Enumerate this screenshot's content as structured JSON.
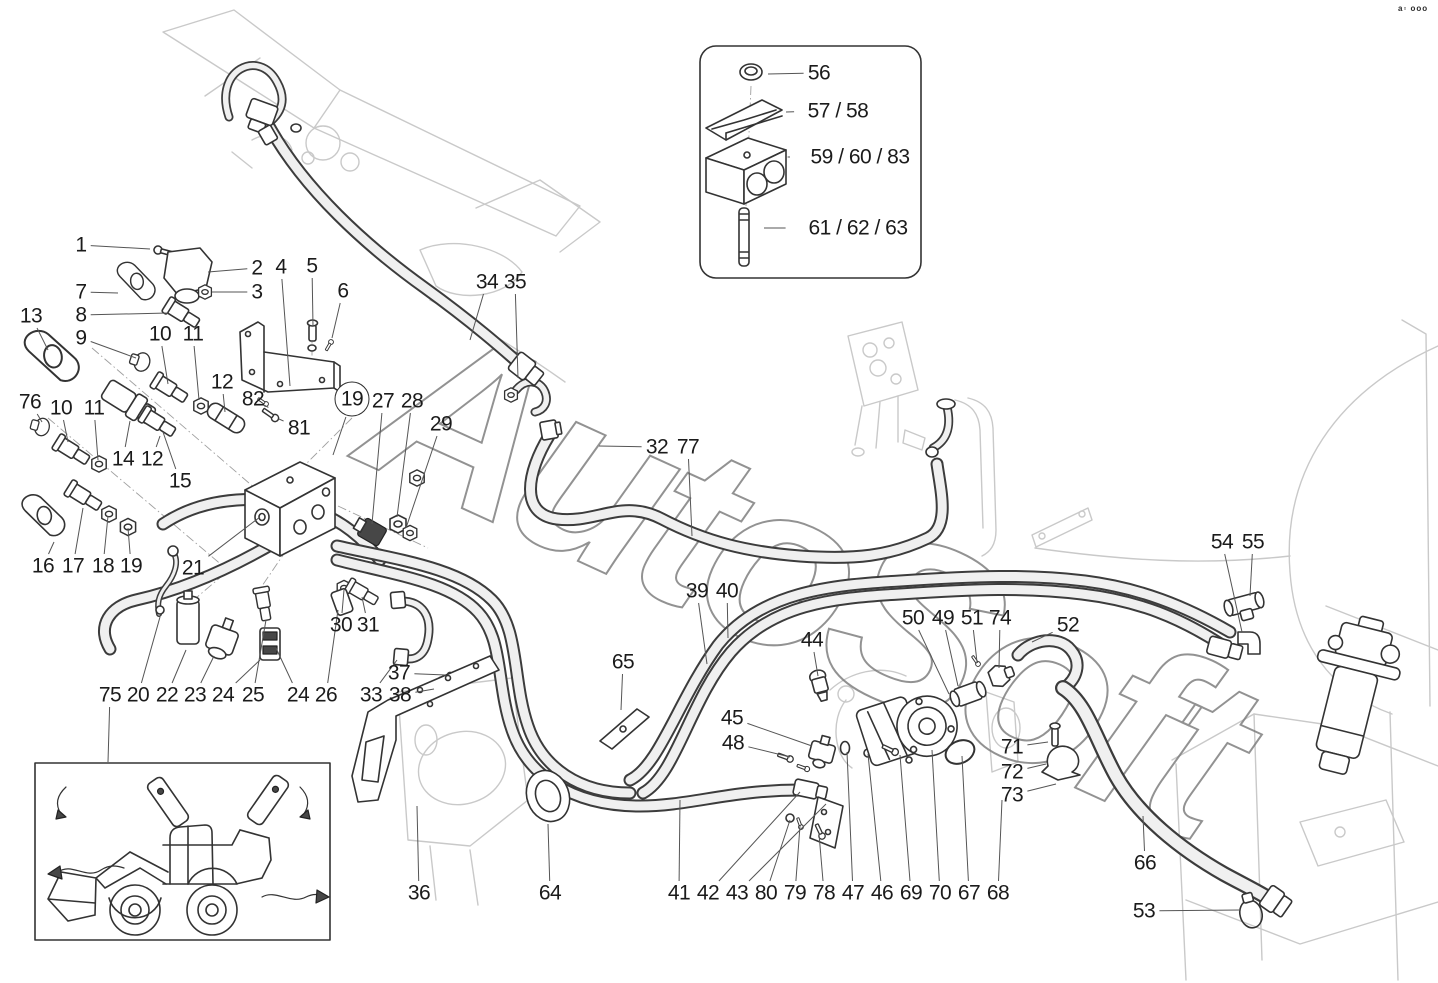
{
  "diagram": {
    "title": "hydraulic-lines-parts-diagram",
    "watermark": "AutoSoft",
    "corner_marks": "a▫ ooo",
    "accent_colors": {
      "ink": "#333333",
      "ghost": "#c9c9c9",
      "hose_core": "#f0f0f0"
    },
    "callouts": [
      {
        "label": "1",
        "x": 81,
        "y": 245,
        "lx": 150,
        "ly": 249
      },
      {
        "label": "2",
        "x": 257,
        "y": 268,
        "lx": 208,
        "ly": 272
      },
      {
        "label": "3",
        "x": 257,
        "y": 292,
        "lx": 212,
        "ly": 292
      },
      {
        "label": "7",
        "x": 81,
        "y": 292,
        "lx": 118,
        "ly": 293
      },
      {
        "label": "8",
        "x": 81,
        "y": 315,
        "lx": 168,
        "ly": 313
      },
      {
        "label": "9",
        "x": 81,
        "y": 338,
        "lx": 136,
        "ly": 358
      },
      {
        "label": "13",
        "x": 31,
        "y": 316,
        "lx": 48,
        "ly": 350
      },
      {
        "label": "10",
        "x": 160,
        "y": 334,
        "lx": 168,
        "ly": 384
      },
      {
        "label": "11",
        "x": 193,
        "y": 334,
        "lx": 199,
        "ly": 400
      },
      {
        "label": "4",
        "x": 281,
        "y": 267,
        "lx": 290,
        "ly": 386
      },
      {
        "label": "5",
        "x": 312,
        "y": 266,
        "lx": 313,
        "ly": 326
      },
      {
        "label": "6",
        "x": 343,
        "y": 291,
        "lx": 332,
        "ly": 338
      },
      {
        "label": "12",
        "x": 222,
        "y": 382,
        "lx": 225,
        "ly": 412
      },
      {
        "label": "82",
        "x": 253,
        "y": 399,
        "lx": 264,
        "ly": 405
      },
      {
        "label": "81",
        "x": 299,
        "y": 428,
        "lx": 279,
        "ly": 419
      },
      {
        "label": "76",
        "x": 30,
        "y": 402,
        "lx": 42,
        "ly": 422
      },
      {
        "label": "10",
        "x": 61,
        "y": 408,
        "lx": 68,
        "ly": 442
      },
      {
        "label": "11",
        "x": 94,
        "y": 408,
        "lx": 98,
        "ly": 460
      },
      {
        "label": "14",
        "x": 123,
        "y": 459,
        "lx": 130,
        "ly": 421
      },
      {
        "label": "12",
        "x": 152,
        "y": 459,
        "lx": 160,
        "ly": 436
      },
      {
        "label": "15",
        "x": 180,
        "y": 481,
        "lx": 163,
        "ly": 432
      },
      {
        "label": "16",
        "x": 43,
        "y": 566,
        "lx": 54,
        "ly": 542
      },
      {
        "label": "17",
        "x": 73,
        "y": 566,
        "lx": 83,
        "ly": 508
      },
      {
        "label": "18",
        "x": 103,
        "y": 566,
        "lx": 108,
        "ly": 516
      },
      {
        "label": "19",
        "x": 131,
        "y": 566,
        "lx": 128,
        "ly": 528
      },
      {
        "label": "21",
        "x": 193,
        "y": 568,
        "lx": 260,
        "ly": 517
      },
      {
        "label": "19",
        "x": 352,
        "y": 399,
        "lx": 333,
        "ly": 455,
        "circled": true
      },
      {
        "label": "27",
        "x": 383,
        "y": 401,
        "lx": 372,
        "ly": 524
      },
      {
        "label": "28",
        "x": 412,
        "y": 401,
        "lx": 397,
        "ly": 517
      },
      {
        "label": "29",
        "x": 441,
        "y": 424,
        "lx": 406,
        "ly": 528
      },
      {
        "label": "30",
        "x": 341,
        "y": 625,
        "lx": 344,
        "ly": 590
      },
      {
        "label": "31",
        "x": 368,
        "y": 625,
        "lx": 362,
        "ly": 597
      },
      {
        "label": "33",
        "x": 371,
        "y": 695,
        "lx": 397,
        "ly": 660
      },
      {
        "label": "38",
        "x": 400,
        "y": 695,
        "lx": 434,
        "ly": 689
      },
      {
        "label": "37",
        "x": 399,
        "y": 673,
        "lx": 446,
        "ly": 675
      },
      {
        "label": "75",
        "x": 110,
        "y": 695,
        "lx": 108,
        "ly": 762
      },
      {
        "label": "20",
        "x": 138,
        "y": 695,
        "lx": 160,
        "ly": 617
      },
      {
        "label": "22",
        "x": 167,
        "y": 695,
        "lx": 186,
        "ly": 650
      },
      {
        "label": "23",
        "x": 195,
        "y": 695,
        "lx": 214,
        "ly": 656
      },
      {
        "label": "24",
        "x": 223,
        "y": 695,
        "lx": 260,
        "ly": 660
      },
      {
        "label": "25",
        "x": 253,
        "y": 695,
        "lx": 266,
        "ly": 620
      },
      {
        "label": "24",
        "x": 298,
        "y": 695,
        "lx": 276,
        "ly": 648
      },
      {
        "label": "26",
        "x": 326,
        "y": 695,
        "lx": 338,
        "ly": 610
      },
      {
        "label": "34",
        "x": 487,
        "y": 282,
        "lx": 470,
        "ly": 340
      },
      {
        "label": "35",
        "x": 515,
        "y": 282,
        "lx": 518,
        "ly": 378
      },
      {
        "label": "32",
        "x": 657,
        "y": 447,
        "lx": 599,
        "ly": 446
      },
      {
        "label": "77",
        "x": 688,
        "y": 447,
        "lx": 692,
        "ly": 536
      },
      {
        "label": "65",
        "x": 623,
        "y": 662,
        "lx": 621,
        "ly": 710
      },
      {
        "label": "39",
        "x": 697,
        "y": 591,
        "lx": 707,
        "ly": 664
      },
      {
        "label": "40",
        "x": 727,
        "y": 591,
        "lx": 728,
        "ly": 638
      },
      {
        "label": "44",
        "x": 812,
        "y": 640,
        "lx": 818,
        "ly": 676
      },
      {
        "label": "45",
        "x": 732,
        "y": 718,
        "lx": 812,
        "ly": 746
      },
      {
        "label": "48",
        "x": 733,
        "y": 743,
        "lx": 790,
        "ly": 757
      },
      {
        "label": "50",
        "x": 913,
        "y": 618,
        "lx": 949,
        "ly": 694
      },
      {
        "label": "49",
        "x": 943,
        "y": 618,
        "lx": 958,
        "ly": 686
      },
      {
        "label": "51",
        "x": 972,
        "y": 618,
        "lx": 977,
        "ly": 662
      },
      {
        "label": "74",
        "x": 1000,
        "y": 618,
        "lx": 999,
        "ly": 668
      },
      {
        "label": "52",
        "x": 1068,
        "y": 625,
        "lx": 1032,
        "ly": 642
      },
      {
        "label": "71",
        "x": 1012,
        "y": 747,
        "lx": 1048,
        "ly": 742
      },
      {
        "label": "72",
        "x": 1012,
        "y": 772,
        "lx": 1046,
        "ly": 764
      },
      {
        "label": "73",
        "x": 1012,
        "y": 795,
        "lx": 1056,
        "ly": 784
      },
      {
        "label": "54",
        "x": 1222,
        "y": 542,
        "lx": 1242,
        "ly": 632
      },
      {
        "label": "55",
        "x": 1253,
        "y": 542,
        "lx": 1250,
        "ly": 596
      },
      {
        "label": "66",
        "x": 1145,
        "y": 863,
        "lx": 1143,
        "ly": 816
      },
      {
        "label": "53",
        "x": 1144,
        "y": 911,
        "lx": 1240,
        "ly": 910
      },
      {
        "label": "36",
        "x": 419,
        "y": 893,
        "lx": 417,
        "ly": 806
      },
      {
        "label": "64",
        "x": 550,
        "y": 893,
        "lx": 548,
        "ly": 824
      },
      {
        "label": "41",
        "x": 679,
        "y": 893,
        "lx": 680,
        "ly": 800
      },
      {
        "label": "42",
        "x": 708,
        "y": 893,
        "lx": 800,
        "ly": 792
      },
      {
        "label": "43",
        "x": 737,
        "y": 893,
        "lx": 826,
        "ly": 804
      },
      {
        "label": "80",
        "x": 766,
        "y": 893,
        "lx": 790,
        "ly": 820
      },
      {
        "label": "79",
        "x": 795,
        "y": 893,
        "lx": 800,
        "ly": 826
      },
      {
        "label": "78",
        "x": 824,
        "y": 893,
        "lx": 819,
        "ly": 834
      },
      {
        "label": "47",
        "x": 853,
        "y": 893,
        "lx": 847,
        "ly": 752
      },
      {
        "label": "46",
        "x": 882,
        "y": 893,
        "lx": 868,
        "ly": 754
      },
      {
        "label": "69",
        "x": 911,
        "y": 893,
        "lx": 900,
        "ly": 755
      },
      {
        "label": "70",
        "x": 940,
        "y": 893,
        "lx": 932,
        "ly": 750
      },
      {
        "label": "67",
        "x": 969,
        "y": 893,
        "lx": 962,
        "ly": 756
      },
      {
        "label": "68",
        "x": 998,
        "y": 893,
        "lx": 1002,
        "ly": 800
      },
      {
        "label": "56",
        "x": 819,
        "y": 73,
        "lx": 768,
        "ly": 74
      },
      {
        "label": "57 / 58",
        "x": 838,
        "y": 111,
        "lx": 786,
        "ly": 112
      },
      {
        "label": "59 / 60 / 83",
        "x": 860,
        "y": 157,
        "lx": 790,
        "ly": 157
      },
      {
        "label": "61 / 62 / 63",
        "x": 858,
        "y": 228,
        "lx": 764,
        "ly": 228
      }
    ]
  }
}
